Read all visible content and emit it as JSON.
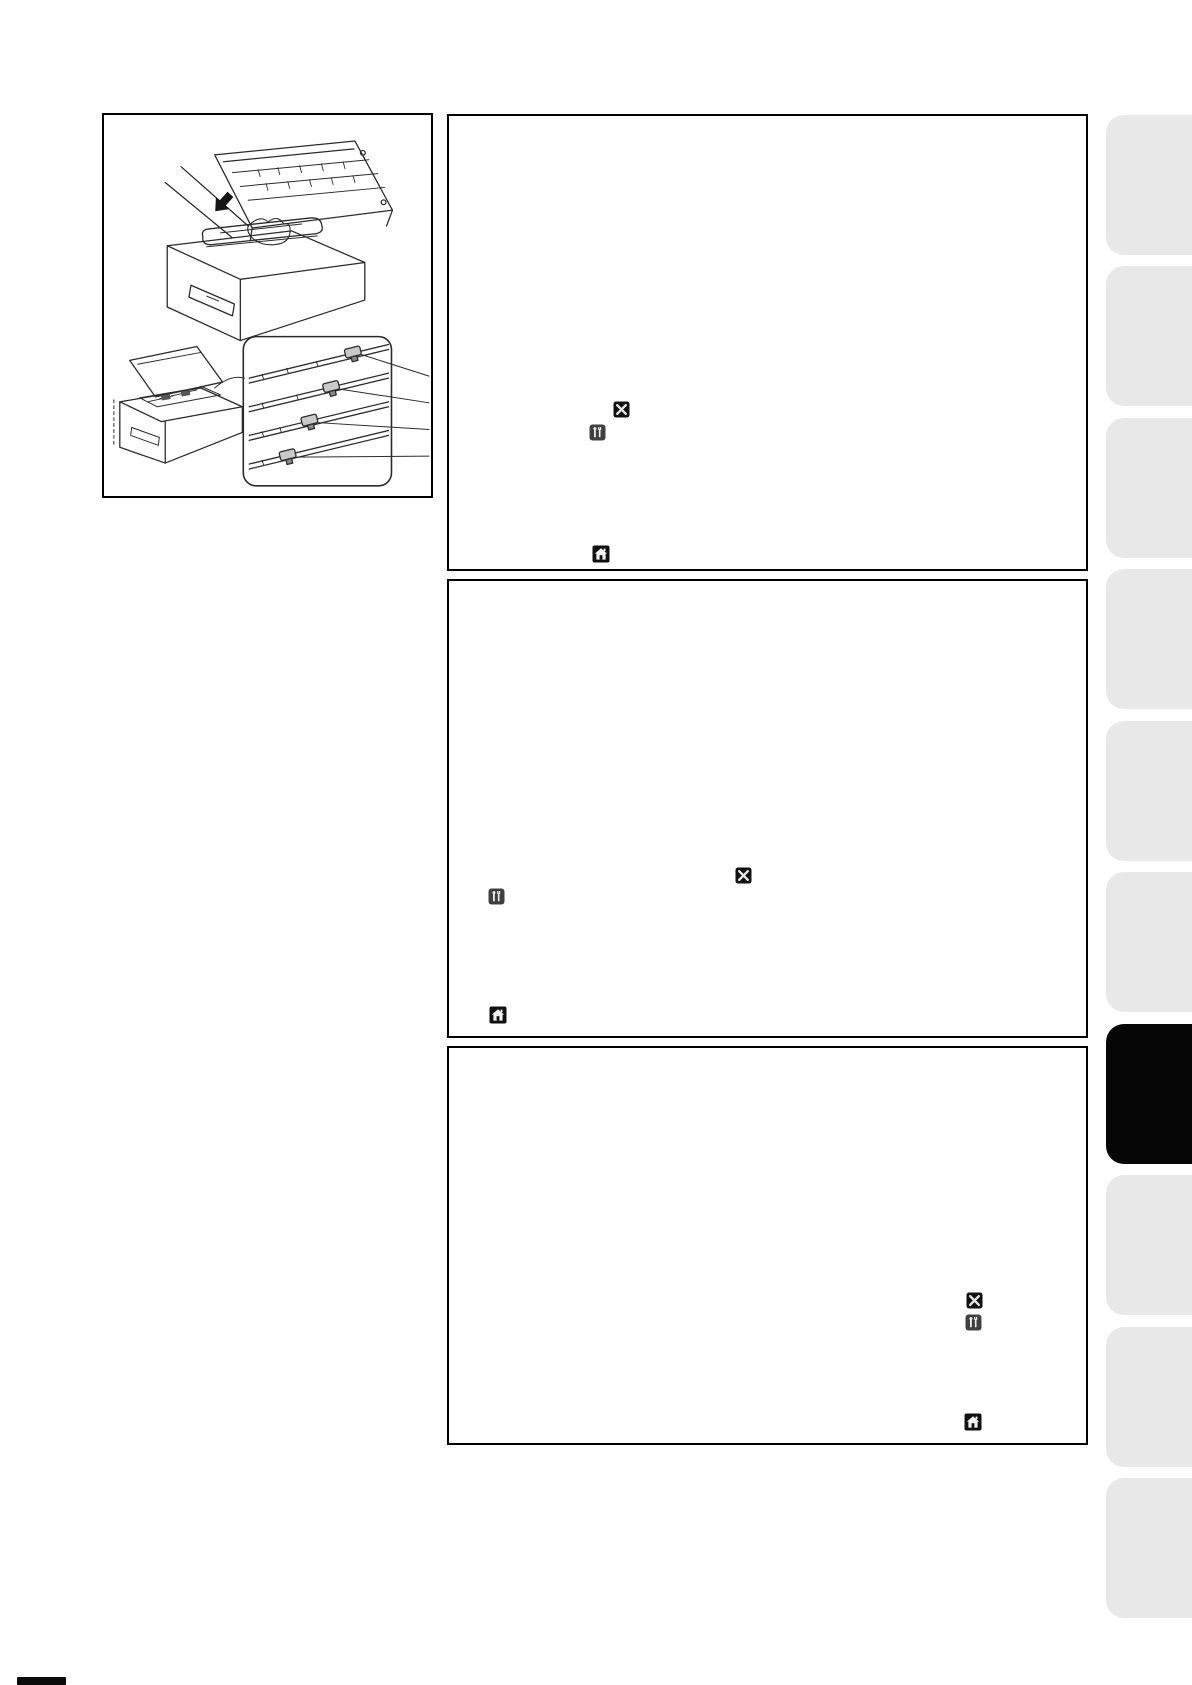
{
  "page": {
    "kind": "printer-manual-page",
    "visible_text": ""
  },
  "illustration": {
    "name": "drum-unit-and-corona-wire-cleaning-figure",
    "elements": [
      "printer-open-top-cover-with-hand-inserting-drum-unit",
      "black-insert-arrow",
      "small-printer-open-top-cover-view",
      "corona-wire-slider-detail-callout",
      "callout-leader-lines"
    ]
  },
  "sections": [
    {
      "name": "instruction-box-1",
      "icons": [
        "cancel-x-icon",
        "settings-tools-icon",
        "home-icon"
      ]
    },
    {
      "name": "instruction-box-2",
      "icons": [
        "cancel-x-icon",
        "settings-tools-icon",
        "home-icon"
      ]
    },
    {
      "name": "instruction-box-3",
      "icons": [
        "cancel-x-icon",
        "settings-tools-icon",
        "home-icon"
      ]
    }
  ],
  "sidebar_tabs": {
    "count": 10,
    "active_index": 7,
    "labels": []
  },
  "colors": {
    "page_bg": "#ffffff",
    "box_border": "#000000",
    "line_art": "#2b2b2b",
    "tab_inactive": "#e8e8e8",
    "tab_active": "#060606",
    "icon_black_bg": "#101010",
    "icon_dark_bg": "#404040",
    "icon_glyph": "#e6e6e6"
  }
}
